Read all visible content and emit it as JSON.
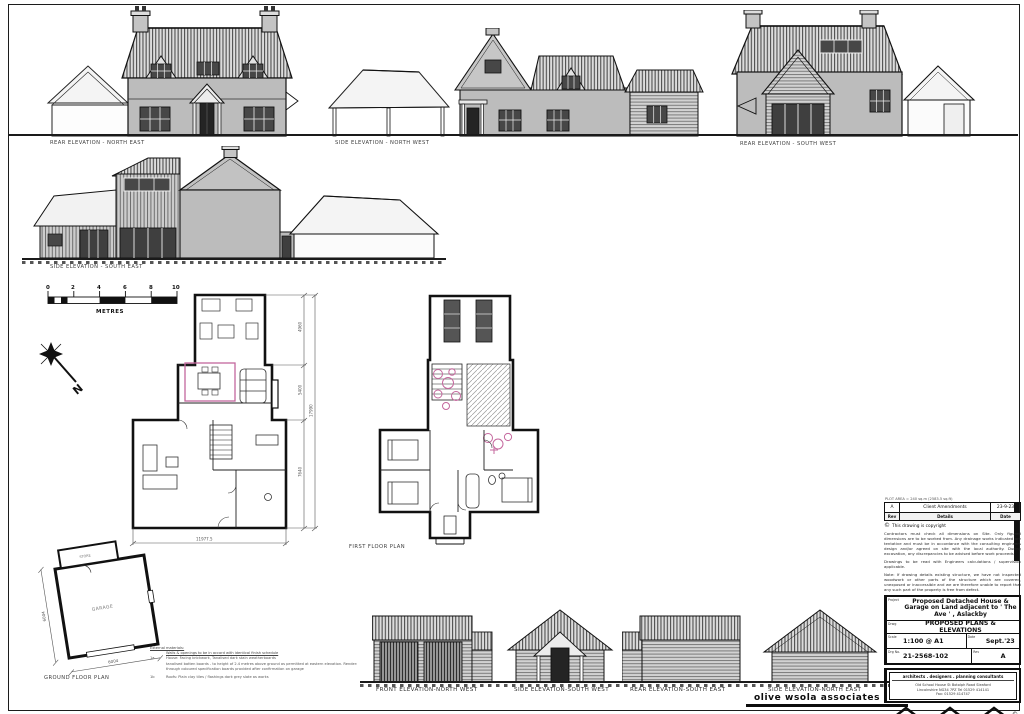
{
  "elevations": {
    "rear_north_east": "REAR  ELEVATION - NORTH EAST",
    "side_north_west": "SIDE  ELEVATION - NORTH WEST",
    "rear_south_west": "REAR  ELEVATION - SOUTH WEST",
    "side_south_east": "SIDE  ELEVATION - SOUTH EAST"
  },
  "plans": {
    "first_floor": "FIRST FLOOR PLAN",
    "ground_floor": "GROUND FLOOR PLAN",
    "room_garage": "GARAGE",
    "room_store": "STORE"
  },
  "garage_elevations": {
    "front_north_west": "FRONT ELEVATION-NORTH WEST",
    "side_south_west": "SIDE ELEVATION-SOUTH WEST",
    "rear_south_east": "REAR ELEVATION-SOUTH EAST",
    "side_north_east": "SIDE ELEVATION-NORTH EAST"
  },
  "scale_bar": {
    "ticks": [
      "0",
      "2",
      "4",
      "6",
      "8",
      "10"
    ],
    "unit": "METRES"
  },
  "north_label": "N",
  "dimensions": {
    "house_width": "11977.5",
    "wing_depth": "4960",
    "mid_depth": "5400",
    "main_depth": "7640",
    "overall_depth": "17990",
    "garage_depth": "6004",
    "garage_width": "6004"
  },
  "materials_notes": {
    "heading": "External materials:",
    "subheading": "Walls & openings to be in accord with identical finish schedule",
    "item1_no": "1a",
    "item1": "House: Facing brickwork, Tanalised dark stain weatherboards",
    "item1_detail": "tanalised batten boards - to height of 2.4 metres above ground as permitted at eastern elevation. Render: through coloured specification boards provided after confirmation on garage",
    "item2_no": "1b",
    "item2": "Roofs: Plain clay tiles / flashings dark grey slate as works"
  },
  "watermark": "olive wsola associates",
  "colors": {
    "accent_pink": "#c4679d",
    "wall_grey": "#bcbcbc",
    "glass_dark": "#474747"
  },
  "title_block": {
    "area_note": "PLOT AREA = 240 sq.m (2583.5 sq.ft)",
    "revision_table": {
      "rows": [
        {
          "rev": "A",
          "details": "Client Amendments",
          "date": "23-9-23"
        }
      ],
      "headers": {
        "rev": "Rev",
        "details": "Details",
        "date": "Date"
      }
    },
    "copyright_symbol": "©",
    "copyright": "This drawing is copyright",
    "notes": [
      "Contractors must check all dimensions on Site. Only figured dimensions are to be worked from. Any drainage works indicated are tentative and must be in accordance with the consulting engineers design and/or agreed on site with the local authority. During excavation, any discrepancies to be advised before work proceeds.",
      "Drawings to be read with Engineers calculations / supervision applicable.",
      "Note: If drawing details existing structure, we have not inspected woodwork or other parts of the structure which are covered, unexposed or inaccessible and we are therefore unable to report that any such part of the property is free from defect."
    ],
    "project_label": "Project",
    "project": "Proposed Detached House & Garage on Land adjacent to ' The Ave ' , Aslackby",
    "drawing_label": "Drwg",
    "drawing_title": "PROPOSED PLANS & ELEVATIONS",
    "scale_label": "Scale",
    "scale": "1:100 @ A1",
    "date_label": "Date",
    "date": "Sept.'23",
    "drg_no_label": "Drg No.",
    "drg_no": "21-2568-102",
    "rev_label": "Rev",
    "rev": "A",
    "firm_tagline": "architects  .  designers  .  planning consultants",
    "firm_address_1": "Old School House    St Botolph Road    Sleaford",
    "firm_address_2": "Lincolnshire    NG34 7PZ    Tel 01529 414141",
    "firm_address_3": "Fax: 01529 414747"
  }
}
